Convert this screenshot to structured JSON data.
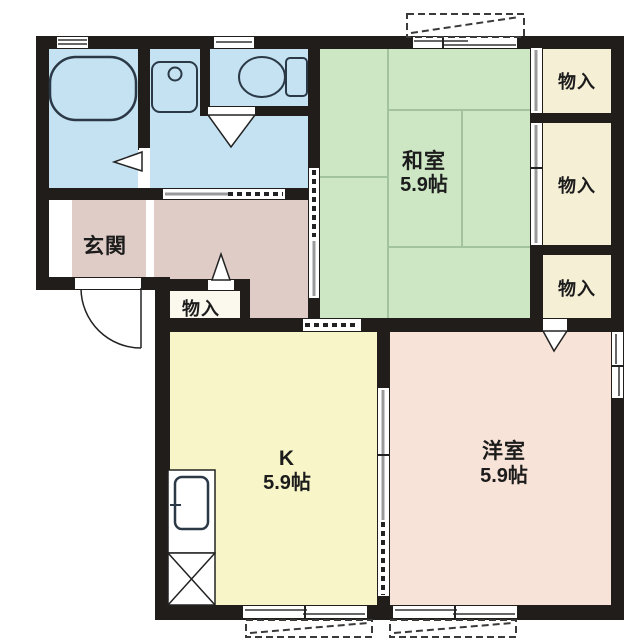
{
  "plan": {
    "kind": "apartment-floor-plan",
    "rooms": {
      "washitsu": {
        "name": "和室",
        "size": "5.9帖"
      },
      "kitchen": {
        "name": "K",
        "size": "5.9帖"
      },
      "youshitsu": {
        "name": "洋室",
        "size": "5.9帖"
      },
      "genkan": {
        "name": "玄関"
      },
      "closet_hall": {
        "name": "物入"
      },
      "closet_top": {
        "name": "物入"
      },
      "closet_middle": {
        "name": "物入"
      },
      "closet_bottom": {
        "name": "物入"
      }
    },
    "fixtures": {
      "bathtub": "bathtub",
      "washbasin": "washbasin",
      "toilet": "toilet",
      "kitchen_sink": "kitchen-sink-counter",
      "crossed_box": "equipment-space",
      "entry_door": "entry-door-swing",
      "balcony": "balcony-outline"
    },
    "colors": {
      "wall": "#211d1a",
      "japanese_room": "#cde7c5",
      "kitchen": "#f8f6c8",
      "western_room": "#f7e3d7",
      "hall": "#e0ccc7",
      "wet_area": "#c4e2f2",
      "storage": "#f5efd5",
      "storage_hall": "#fbf9ee",
      "tatami_line": "#a3c29e",
      "fixture_line": "#2b3947"
    }
  }
}
